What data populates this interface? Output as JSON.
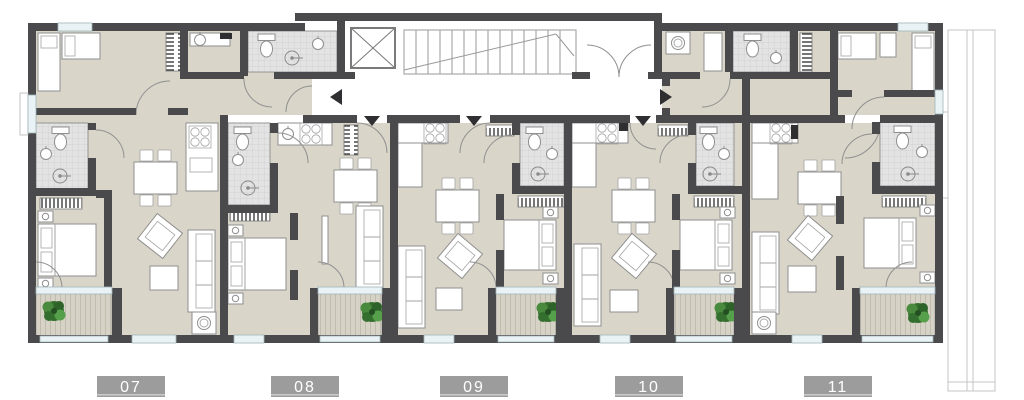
{
  "plan": {
    "type": "residential-floor-plan",
    "units": [
      {
        "label": "07"
      },
      {
        "label": "08"
      },
      {
        "label": "09"
      },
      {
        "label": "10"
      },
      {
        "label": "11"
      }
    ],
    "colors": {
      "wall": "#4a4a4c",
      "floor": "#d9d5c9",
      "corridor": "#ffffff",
      "bathroom_tile": "#e3e3e3",
      "balcony_deck": "#d6d2c5",
      "window_glass": "#e9f3f6",
      "plant_green": "#35702f",
      "label_background": "#9c9c9c",
      "label_text": "#ffffff",
      "furniture_fill": "#ffffff",
      "furniture_outline": "#8f8f8f",
      "terrace_outline": "#c4c4c4",
      "arrow": "#2f2f31"
    },
    "icons": [
      "elevator-icon",
      "stairs-icon",
      "plant-icon",
      "toilet-icon",
      "sink-icon",
      "shower-icon",
      "stove-icon",
      "washing-machine-icon",
      "arrow-left-icon",
      "arrow-right-icon",
      "arrow-down-icon"
    ]
  }
}
